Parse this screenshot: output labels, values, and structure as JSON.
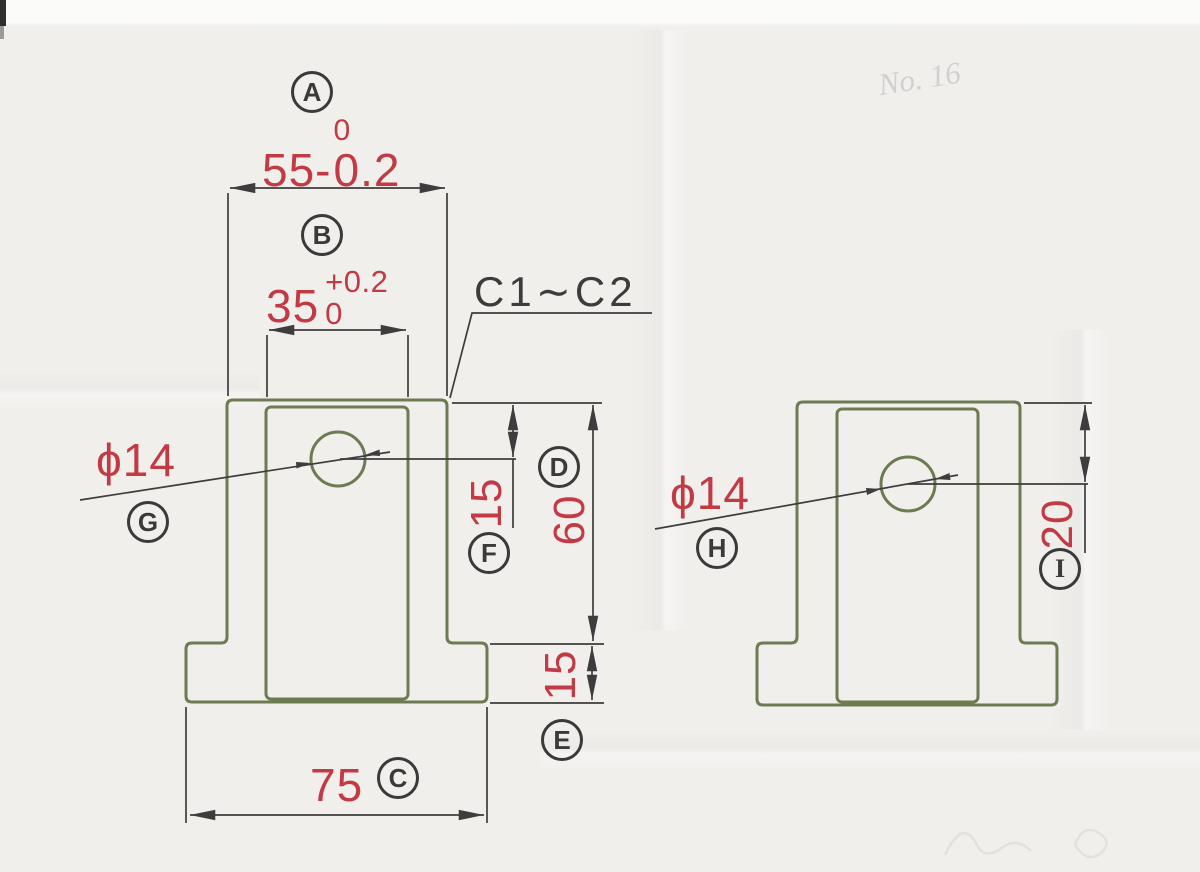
{
  "drawing": {
    "balloons": {
      "a": "A",
      "b": "B",
      "c": "C",
      "d": "D",
      "e": "E",
      "f": "F",
      "g": "G",
      "h": "H",
      "i": "I"
    },
    "dims": {
      "width_55": {
        "base": "55-",
        "tol_top": "0",
        "tol_bottom": "0.2"
      },
      "width_35": {
        "base": "35",
        "tol_top": "+0.2",
        "tol_bottom": "0"
      },
      "chamfer_note": "C1∼C2",
      "hole_dia_front": "ϕ14",
      "hole_dia_side": "ϕ14",
      "hole_depth_front": "15",
      "body_height": "60",
      "flange_height": "15",
      "flange_width": "75",
      "hole_depth_side": "20"
    },
    "pencil_note": "No. 16",
    "colors": {
      "paper": "#f1efec",
      "outline_green": "#6d7b52",
      "line_black": "#3d3d3d",
      "dim_red": "#c23a44"
    }
  }
}
